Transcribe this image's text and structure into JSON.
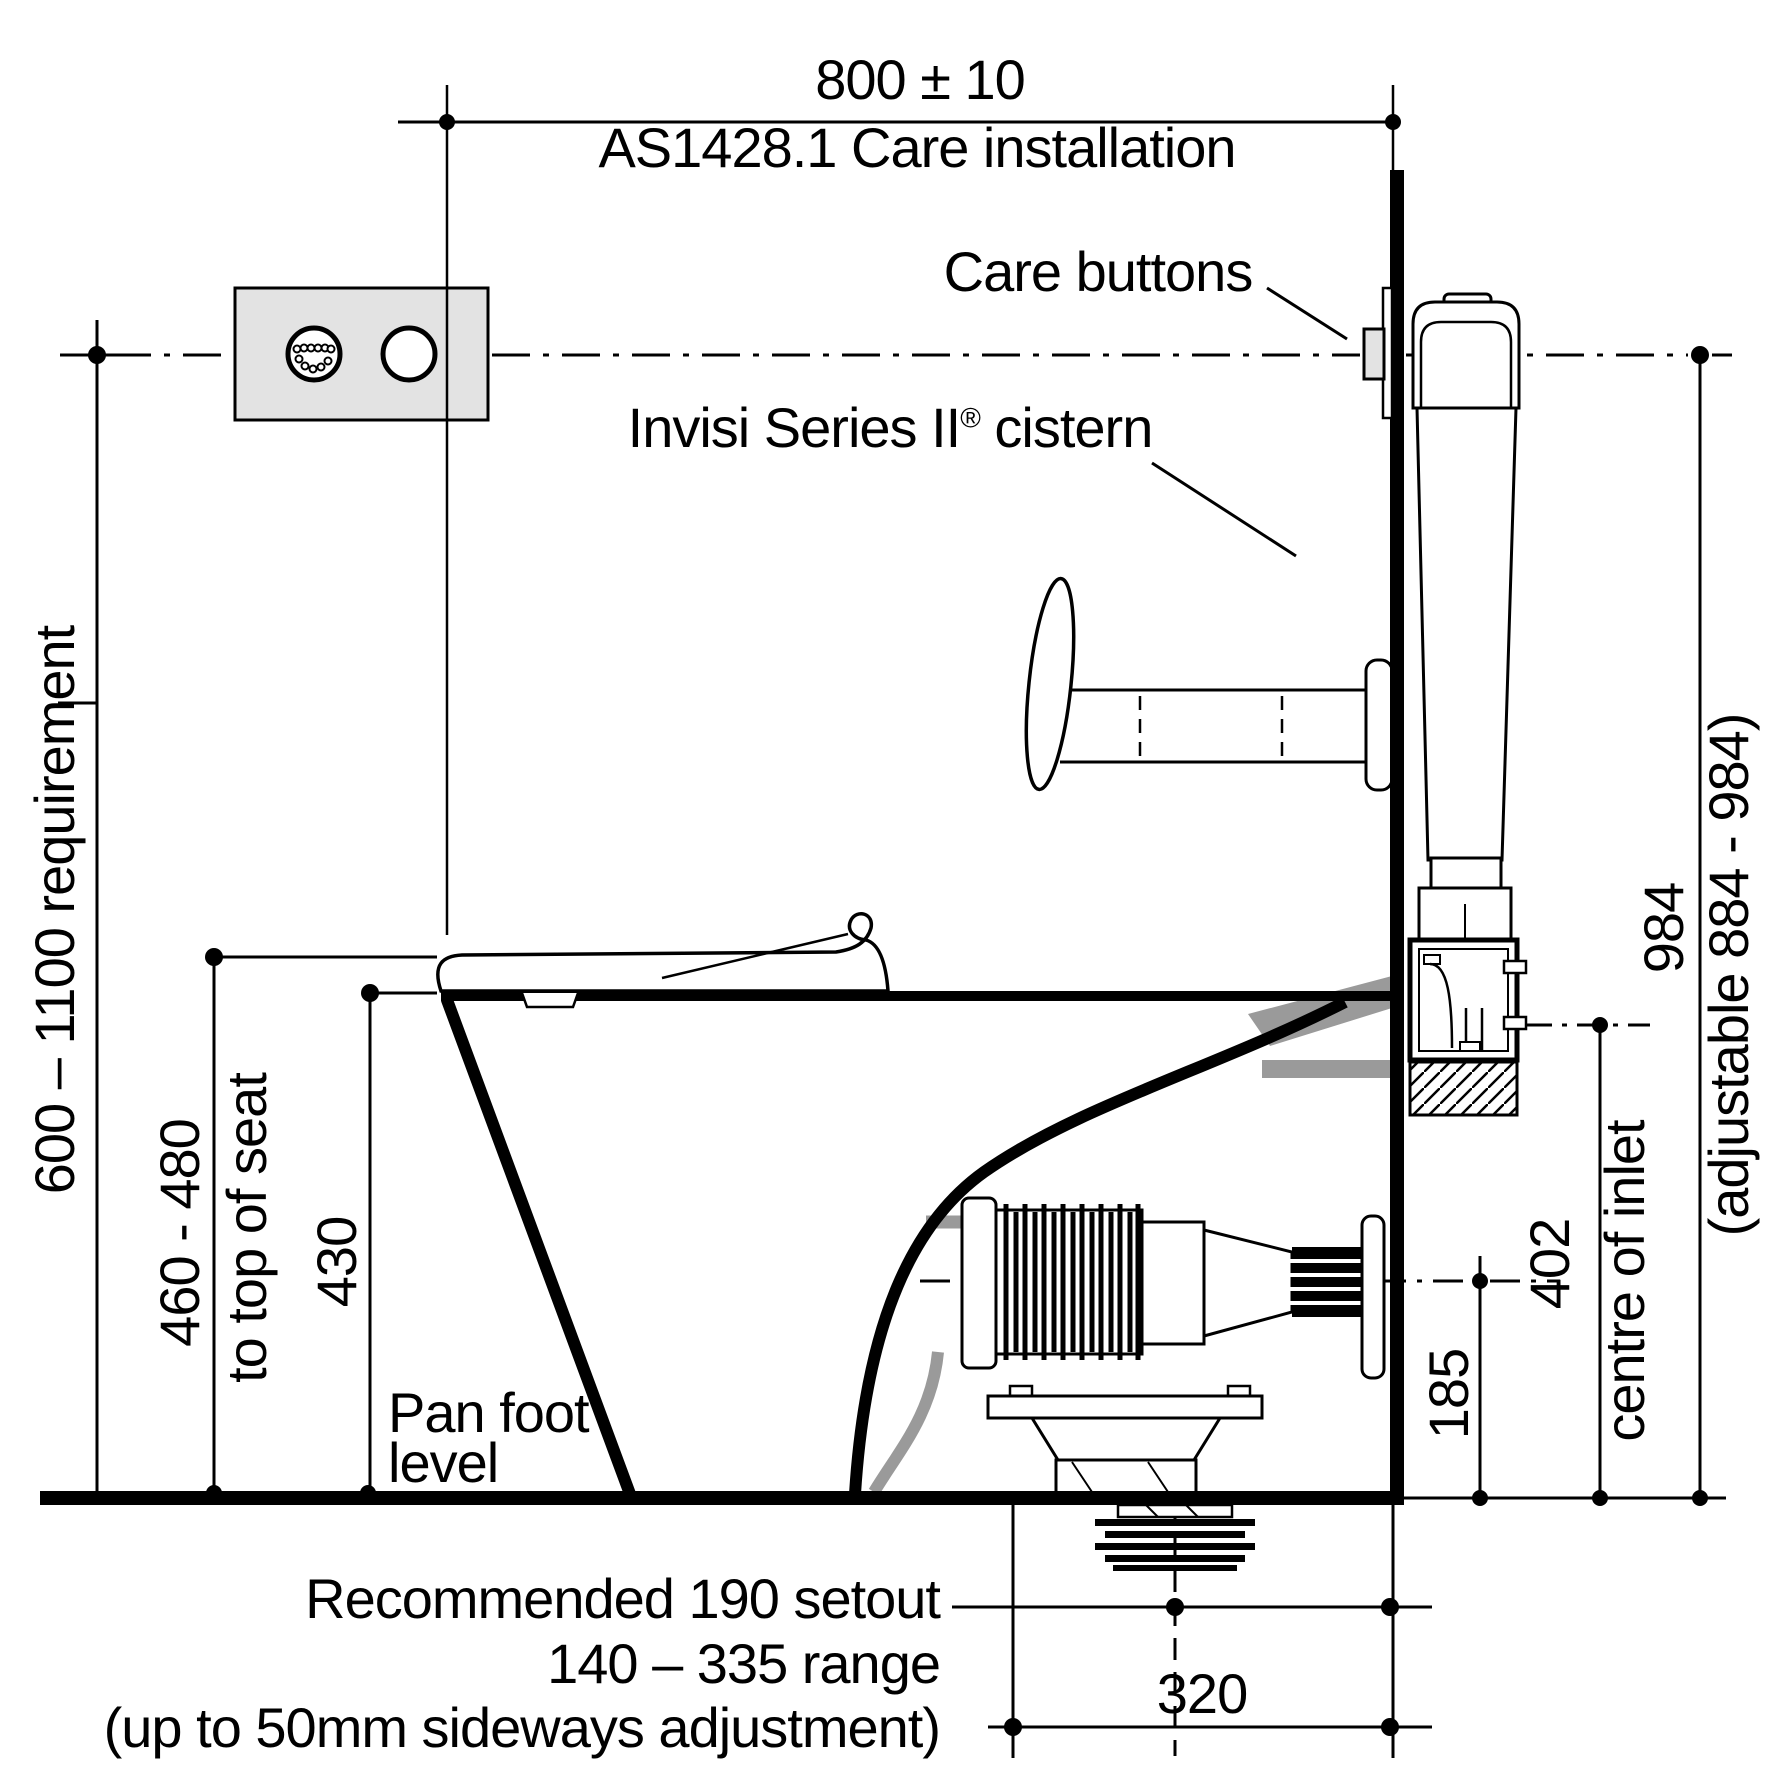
{
  "title": {
    "width_dim": "800 ± 10",
    "standard": "AS1428.1 Care installation"
  },
  "callouts": {
    "care_buttons": "Care buttons",
    "cistern_name": "Invisi Series II",
    "cistern_reg": "®",
    "cistern_suffix": " cistern"
  },
  "left_dimensions": {
    "requirement": "600 – 1100 requirement",
    "seat_range": "460 - 480",
    "seat_note": "to top of seat",
    "pan_height": "430",
    "pan_foot": [
      "Pan foot",
      "level"
    ]
  },
  "right_dimensions": {
    "inlet_height": "185",
    "inlet_centre_height": "402",
    "inlet_label": "centre of inlet",
    "button_height": "984",
    "adjustable_range": "(adjustable 884 - 984)"
  },
  "bottom_dimensions": {
    "recommended": "Recommended 190 setout",
    "range": "140 – 335 range",
    "sideways": "(up to 50mm sideways adjustment)",
    "offset": "320"
  },
  "colors": {
    "line": "#000000",
    "panel_grey": "#e3e3e3",
    "pipe_grey": "#9a9a9a",
    "background": "#ffffff"
  }
}
